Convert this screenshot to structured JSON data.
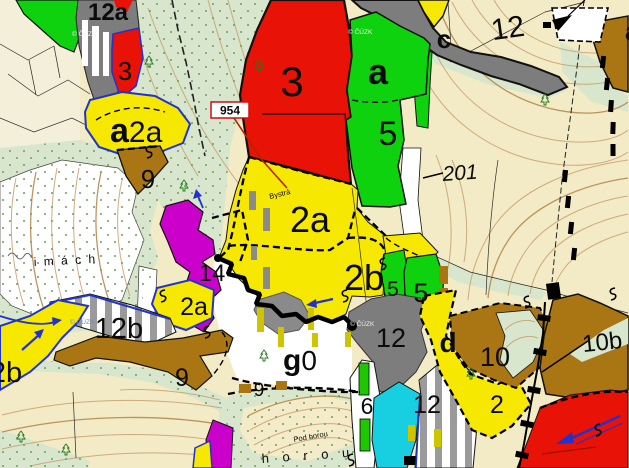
{
  "app": {
    "name": "forest stand map viewer"
  },
  "map": {
    "watermark": "© ČÚZK",
    "stand_labels": {
      "top_left_12a": "12a",
      "red_small_3": "3",
      "a2a_prefix": "a",
      "a2a_suffix": "2a",
      "brown_top_9": "9",
      "red_big_3": "3",
      "green_a": "a",
      "green_5": "5",
      "road_c": "c",
      "top_right_12": "12",
      "edge_a": "a",
      "road_201": "201",
      "yellow_2a": "2a",
      "yellow_2b": "2b",
      "green_5a": "5",
      "green_5b": "5",
      "magenta_14": "14",
      "yellow_2a_small": "2a",
      "stripe_12b": "12b",
      "yellow_2b_left": "2b",
      "brown_9": "9",
      "g0_prefix": "g",
      "g0_suffix": "0",
      "white_9": "9",
      "gray_12": "12",
      "green_bar_6": "6",
      "yellow_d": "d",
      "brown_10": "10",
      "yellow_2": "2",
      "stripe_12": "12",
      "slope_10b": "10b"
    },
    "point_labels": {
      "km_954": "954"
    },
    "place_labels": {
      "imach": "i m á c h",
      "bystra": "Bystrá",
      "pod_horou": "Pod horou",
      "horou": "h o r o u"
    },
    "colors": {
      "stand_yellow": "#f6e800",
      "stand_red": "#e81207",
      "stand_green": "#0fd20f",
      "stand_brown": "#a97613",
      "road_gray": "#7d7d7d",
      "stand_magenta": "#cb00cb",
      "stand_cyan": "#17cfe0",
      "meadow_mint": "#d8e6cd",
      "field_beige": "#f3ebc6",
      "boundary_blue": "#2233cc",
      "contour_tan": "#c79f6b"
    }
  }
}
